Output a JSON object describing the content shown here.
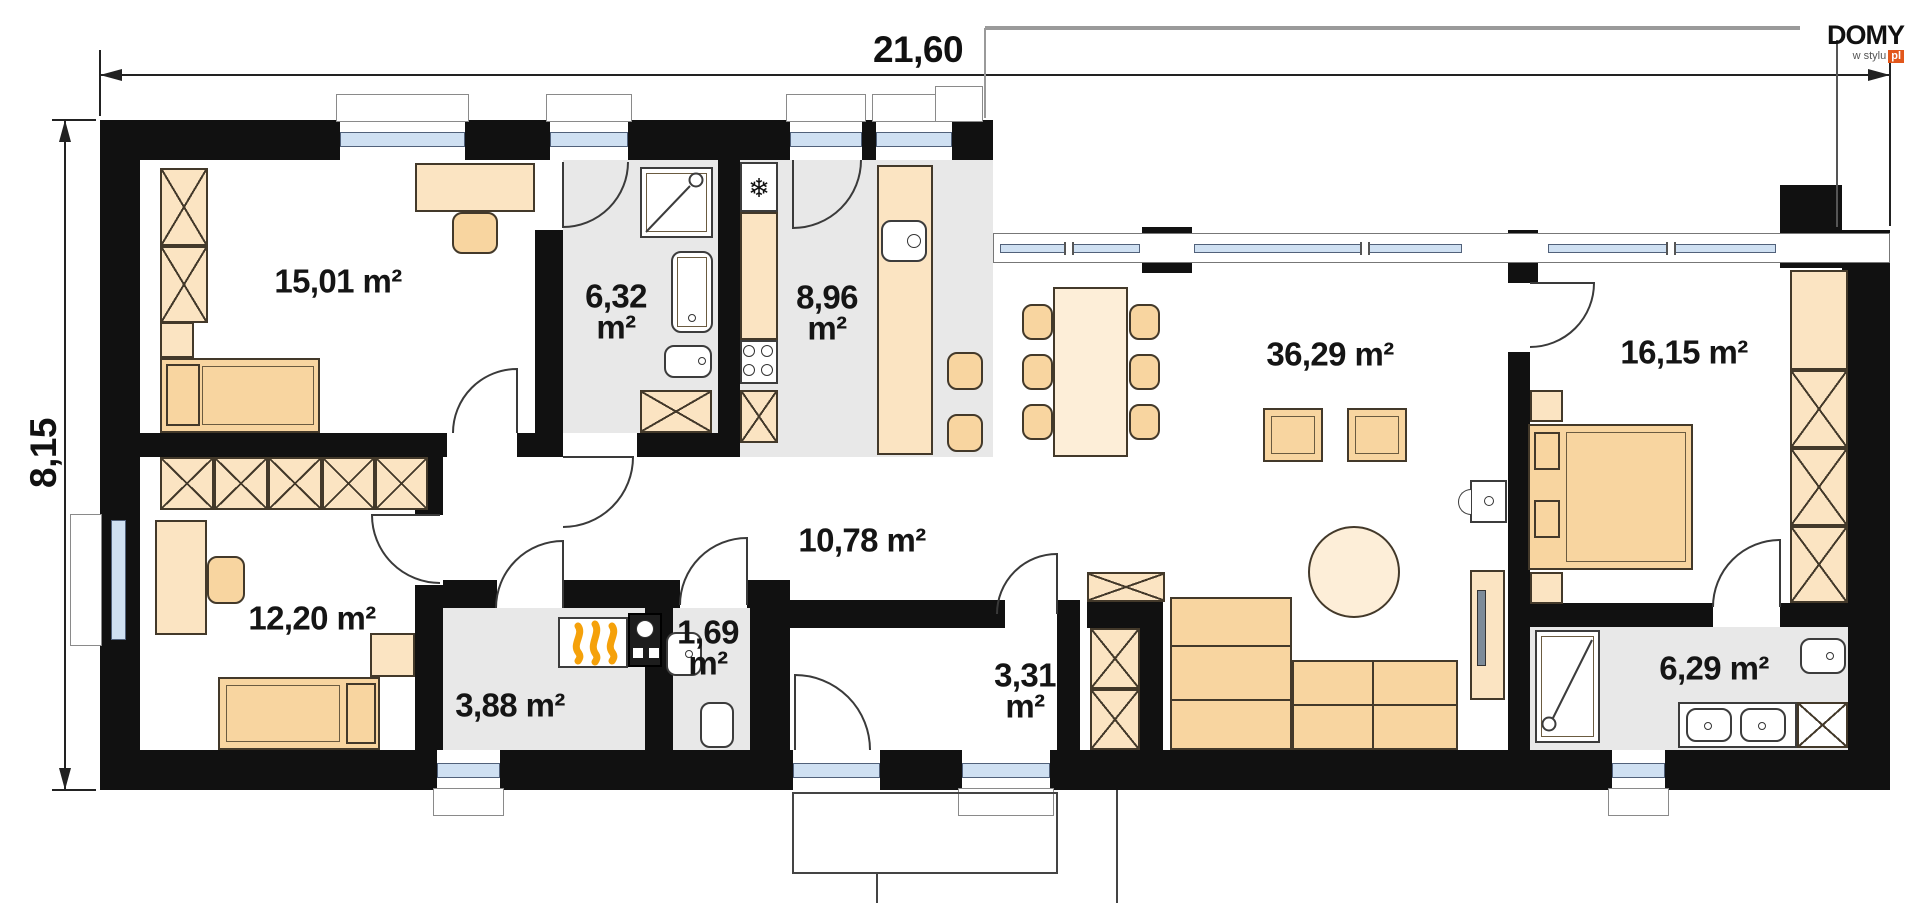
{
  "plan": {
    "dimensions": {
      "width": "21,60",
      "height": "8,15"
    },
    "rooms": [
      {
        "id": "bedroom-1",
        "area": "15,01",
        "unit": "m²"
      },
      {
        "id": "bathroom-1",
        "area": "6,32",
        "unit": "m²"
      },
      {
        "id": "kitchen",
        "area": "8,96",
        "unit": "m²"
      },
      {
        "id": "living-room",
        "area": "36,29",
        "unit": "m²"
      },
      {
        "id": "bedroom-2",
        "area": "16,15",
        "unit": "m²"
      },
      {
        "id": "bedroom-3",
        "area": "12,20",
        "unit": "m²"
      },
      {
        "id": "hall",
        "area": "10,78",
        "unit": "m²"
      },
      {
        "id": "wc",
        "area": "1,69",
        "unit": "m²"
      },
      {
        "id": "utility",
        "area": "3,88",
        "unit": "m²"
      },
      {
        "id": "vestibule",
        "area": "3,31",
        "unit": "m²"
      },
      {
        "id": "bathroom-2",
        "area": "6,29",
        "unit": "m²"
      }
    ],
    "logo": {
      "brand": "DOMY",
      "tagline": "w stylu",
      "suffix": "pl"
    },
    "icons": {
      "fridge": "❄"
    },
    "colors": {
      "wall": "#111111",
      "floor_gray": "#e8e8e8",
      "furniture": "#fbe4c2",
      "furniture_deep": "#f8d5a0",
      "glazing": "#cfe0f2",
      "accent_orange": "#e2571b",
      "flame": "#f5a10a"
    }
  }
}
